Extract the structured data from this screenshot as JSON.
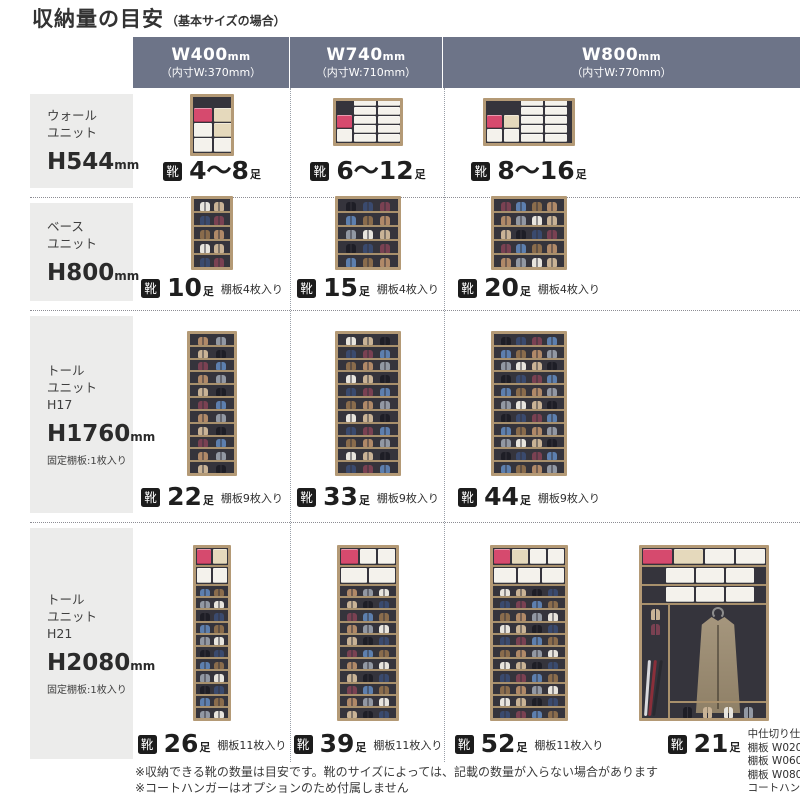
{
  "title": {
    "main": "収納量の目安",
    "sub": "（基本サイズの場合）"
  },
  "shoe_label": "靴",
  "columns": [
    {
      "size": "W400",
      "size_unit": "mm",
      "inner": "（内寸W:370mm）"
    },
    {
      "size": "W740",
      "size_unit": "mm",
      "inner": "（内寸W:710mm）"
    },
    {
      "size": "W800",
      "size_unit": "mm",
      "inner": "（内寸W:770mm）"
    }
  ],
  "rows": [
    {
      "unit_lines": [
        "ウォール",
        "ユニット"
      ],
      "height": "H544",
      "height_unit": "mm",
      "fixed_note": "",
      "cells": [
        {
          "count": "4～8",
          "count_unit": "足",
          "note": "",
          "cabinet": {
            "kind": "boxes",
            "w": 44,
            "h": 62,
            "mb": 0,
            "stacks": [
              {
                "w": 18,
                "bh": 13,
                "boxes": [
                  "pink",
                  "white",
                  "white"
                ]
              },
              {
                "w": 18,
                "bh": 13,
                "boxes": [
                  "cream",
                  "cream",
                  "white"
                ]
              }
            ]
          }
        },
        {
          "count": "6～12",
          "count_unit": "足",
          "note": "",
          "cabinet": {
            "kind": "boxes",
            "w": 70,
            "h": 48,
            "mb": 10,
            "stacks": [
              {
                "w": 15,
                "bh": 12,
                "boxes": [
                  "pink",
                  "white"
                ]
              },
              {
                "w": 22,
                "bh": 7,
                "boxes": [
                  "white",
                  "white",
                  "white",
                  "white",
                  "white"
                ]
              },
              {
                "w": 22,
                "bh": 7,
                "boxes": [
                  "white",
                  "white",
                  "white",
                  "white",
                  "white"
                ]
              }
            ]
          }
        },
        {
          "count": "8～16",
          "count_unit": "足",
          "note": "",
          "cabinet": {
            "kind": "boxes",
            "w": 92,
            "h": 48,
            "mb": 10,
            "stacks": [
              {
                "w": 15,
                "bh": 12,
                "boxes": [
                  "pink",
                  "white"
                ]
              },
              {
                "w": 15,
                "bh": 12,
                "boxes": [
                  "cream",
                  "white"
                ]
              },
              {
                "w": 22,
                "bh": 7,
                "boxes": [
                  "white",
                  "white",
                  "white",
                  "white",
                  "white"
                ]
              },
              {
                "w": 22,
                "bh": 7,
                "boxes": [
                  "white",
                  "white",
                  "white",
                  "white",
                  "white"
                ]
              }
            ]
          }
        }
      ]
    },
    {
      "unit_lines": [
        "ベース",
        "ユニット"
      ],
      "height": "H800",
      "height_unit": "mm",
      "fixed_note": "",
      "cells": [
        {
          "count": "10",
          "count_unit": "足",
          "note": "棚板4枚入り",
          "cabinet": {
            "kind": "shelves",
            "w": 42,
            "h": 74,
            "mb": 0,
            "rows": 5,
            "pairs": 2
          }
        },
        {
          "count": "15",
          "count_unit": "足",
          "note": "棚板4枚入り",
          "cabinet": {
            "kind": "shelves",
            "w": 66,
            "h": 74,
            "mb": 0,
            "rows": 5,
            "pairs": 3
          }
        },
        {
          "count": "20",
          "count_unit": "足",
          "note": "棚板4枚入り",
          "cabinet": {
            "kind": "shelves",
            "w": 76,
            "h": 74,
            "mb": 0,
            "rows": 5,
            "pairs": 4
          }
        }
      ]
    },
    {
      "unit_lines": [
        "トール",
        "ユニット",
        "H17"
      ],
      "height": "H1760",
      "height_unit": "mm",
      "fixed_note": "固定棚板:1枚入り",
      "cells": [
        {
          "count": "22",
          "count_unit": "足",
          "note": "棚板9枚入り",
          "cabinet": {
            "kind": "shelves",
            "w": 50,
            "h": 145,
            "mb": 0,
            "rows": 11,
            "pairs": 2
          }
        },
        {
          "count": "33",
          "count_unit": "足",
          "note": "棚板9枚入り",
          "cabinet": {
            "kind": "shelves",
            "w": 66,
            "h": 145,
            "mb": 0,
            "rows": 11,
            "pairs": 3
          }
        },
        {
          "count": "44",
          "count_unit": "足",
          "note": "棚板9枚入り",
          "cabinet": {
            "kind": "shelves",
            "w": 76,
            "h": 145,
            "mb": 0,
            "rows": 11,
            "pairs": 4
          }
        }
      ]
    },
    {
      "unit_lines": [
        "トール",
        "ユニット",
        "H21"
      ],
      "height": "H2080",
      "height_unit": "mm",
      "fixed_note": "固定棚板:1枚入り",
      "cells": [
        {
          "count": "26",
          "count_unit": "足",
          "note": "棚板11枚入り",
          "cabinet": {
            "kind": "boxshelves",
            "w": 38,
            "h": 176,
            "mb": 0,
            "rows": 11,
            "pairs": 2,
            "boxRows": [
              [
                "pink",
                "cream"
              ],
              [
                "white",
                "white"
              ]
            ]
          }
        },
        {
          "count": "39",
          "count_unit": "足",
          "note": "棚板11枚入り",
          "cabinet": {
            "kind": "boxshelves",
            "w": 62,
            "h": 176,
            "mb": 0,
            "rows": 11,
            "pairs": 3,
            "boxRows": [
              [
                "pink",
                "white",
                "white"
              ],
              [
                "white",
                "white"
              ]
            ]
          }
        },
        {
          "count": "52",
          "count_unit": "足",
          "note": "棚板11枚入り",
          "cabinet": {
            "kind": "boxshelves",
            "w": 78,
            "h": 176,
            "mb": 0,
            "rows": 11,
            "pairs": 4,
            "boxRows": [
              [
                "pink",
                "cream",
                "white",
                "white"
              ],
              [
                "white",
                "white",
                "white"
              ]
            ]
          }
        },
        {
          "count": "21",
          "count_unit": "足",
          "note": "",
          "notes_list": [
            "中仕切り仕様",
            "棚板 W020 2枚入り",
            "棚板 W060 2枚入り",
            "棚板 W080 2枚入り",
            "コートハンガー"
          ],
          "cabinet": {
            "kind": "coat",
            "w": 130,
            "h": 176,
            "mb": 0,
            "boxRows": [
              [
                "pink",
                "cream",
                "white",
                "white"
              ],
              [
                "white",
                "white",
                "white"
              ],
              [
                "white",
                "white",
                "white"
              ]
            ]
          }
        }
      ]
    }
  ],
  "footnotes": [
    "※収納できる靴の数量は目安です。靴のサイズによっては、記載の数量が入らない場合があります",
    "※コートハンガーはオプションのため付属しません"
  ],
  "colors": {
    "header_bg": "#6d7488",
    "sidebar_bg": "#ececeb",
    "frame": "#b49a76",
    "interior": "#35343c",
    "shelf": "#a8906c",
    "box_white": "#f4f2ec",
    "box_cream": "#e5d9bc",
    "box_pink": "#d64a6e",
    "icon_bg": "#1c1c1c",
    "text": "#3a3a3a"
  },
  "shoe_palette": [
    "#1e1e26",
    "#8a6c4c",
    "#c9b396",
    "#5d7fae",
    "#e8e5de",
    "#7a4152",
    "#9298a3",
    "#3a4a6e",
    "#b08968"
  ]
}
